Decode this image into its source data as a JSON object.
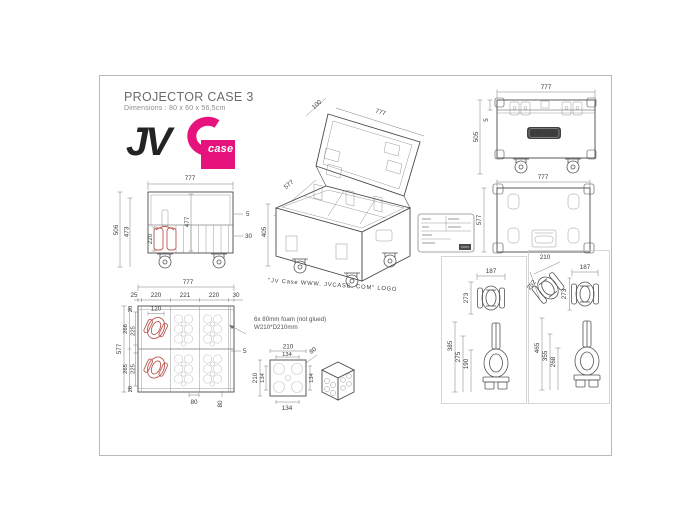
{
  "title": "PROJECTOR CASE 3",
  "subtitle": "Dimensions : 80 x 60 x 56,5cm",
  "logo": {
    "jv": "JV",
    "case": "case"
  },
  "brand_plate": "BRITEQ",
  "iso_caption": "\"JV Case WWW. JVCASE. COM\" LOGO",
  "foam_note": {
    "line1": "6x 80mm foam (not glued)",
    "line2": "W210*D210mm"
  },
  "colors": {
    "accent_pink": "#e6137d",
    "fixture_red": "#bb5a52",
    "line": "#4a4a4a"
  },
  "dims": {
    "front": {
      "w": "777",
      "h_outer": "506",
      "h_inner": "473",
      "cavity": "477",
      "fixture": "220",
      "lid": "5",
      "strip": "30"
    },
    "iso": {
      "lid": "100",
      "w": "777",
      "d": "577",
      "h": "405"
    },
    "closed": {
      "w": "777",
      "h": "505",
      "lid": "5"
    },
    "top": {
      "w": "777",
      "d": "577"
    },
    "interior": {
      "w": "777",
      "d": "577",
      "c0": "25",
      "c1": "220",
      "c2": "221",
      "c3": "220",
      "c4": "30",
      "r0": "20",
      "r1": "266",
      "r2": "225",
      "r3": "265",
      "r4": "225",
      "r5": "20",
      "cutout": "120",
      "wall": "5",
      "b0": "80",
      "b1": "80"
    },
    "foam": {
      "w": "210",
      "wi": "134",
      "d": "210",
      "di": "134",
      "side": "134",
      "bottom": "134",
      "th": "80"
    },
    "detl": {
      "w": "187",
      "h": "273",
      "s0": "385",
      "s1": "275",
      "s2": "190"
    },
    "detr": {
      "aw": "210",
      "ah": "252",
      "bw": "187",
      "bh": "273",
      "s0": "465",
      "s1": "355",
      "s2": "268"
    }
  }
}
